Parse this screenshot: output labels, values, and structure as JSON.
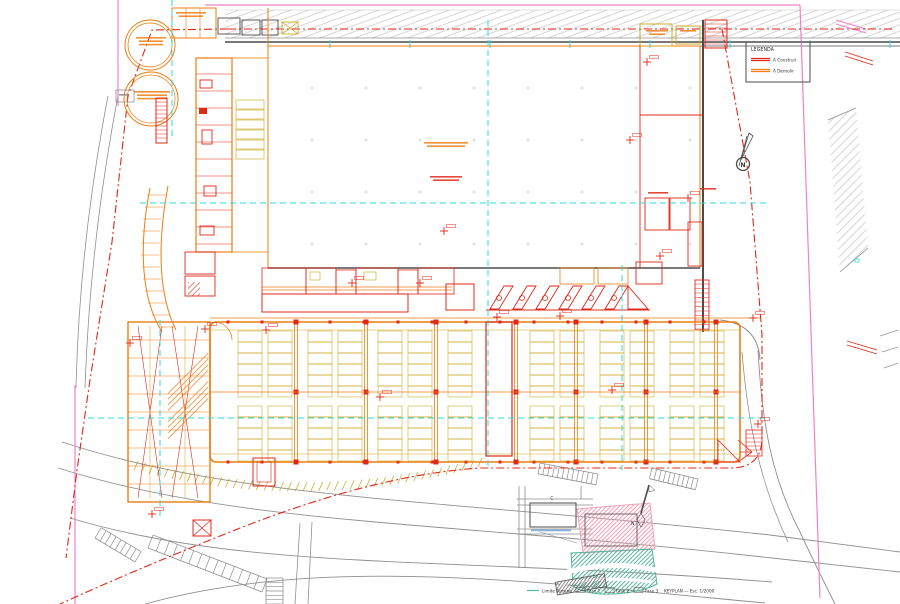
{
  "colors": {
    "red": "#e02818",
    "orange": "#ef7d10",
    "yellow": "#c9a416",
    "cyan": "#2fd8d8",
    "pink": "#ef82c8",
    "gray": "#8f8f8f",
    "light_gray": "#c4c4c4",
    "dark": "#4b4b4b",
    "kp_blue": "#3c7cc8",
    "kp_teal": "#58b49c",
    "kp_pink": "#f0a4b8",
    "hatch_dark": "#6f6f6f"
  },
  "legend": {
    "title": "LEGENDA",
    "items": [
      {
        "label": "A Construir",
        "color_key": "red"
      },
      {
        "label": "A Demolir",
        "color_key": "orange"
      }
    ]
  },
  "north": {
    "label": "N"
  },
  "keyplan": {
    "block_label": "C",
    "north_label": "N",
    "caption": {
      "limite": "Limite Terreno",
      "fase1": "Fase 1",
      "fase2": "Fase 2",
      "fase3": "Fase 3",
      "scale": "KEYPLAN — Esc. 1/2000"
    }
  }
}
